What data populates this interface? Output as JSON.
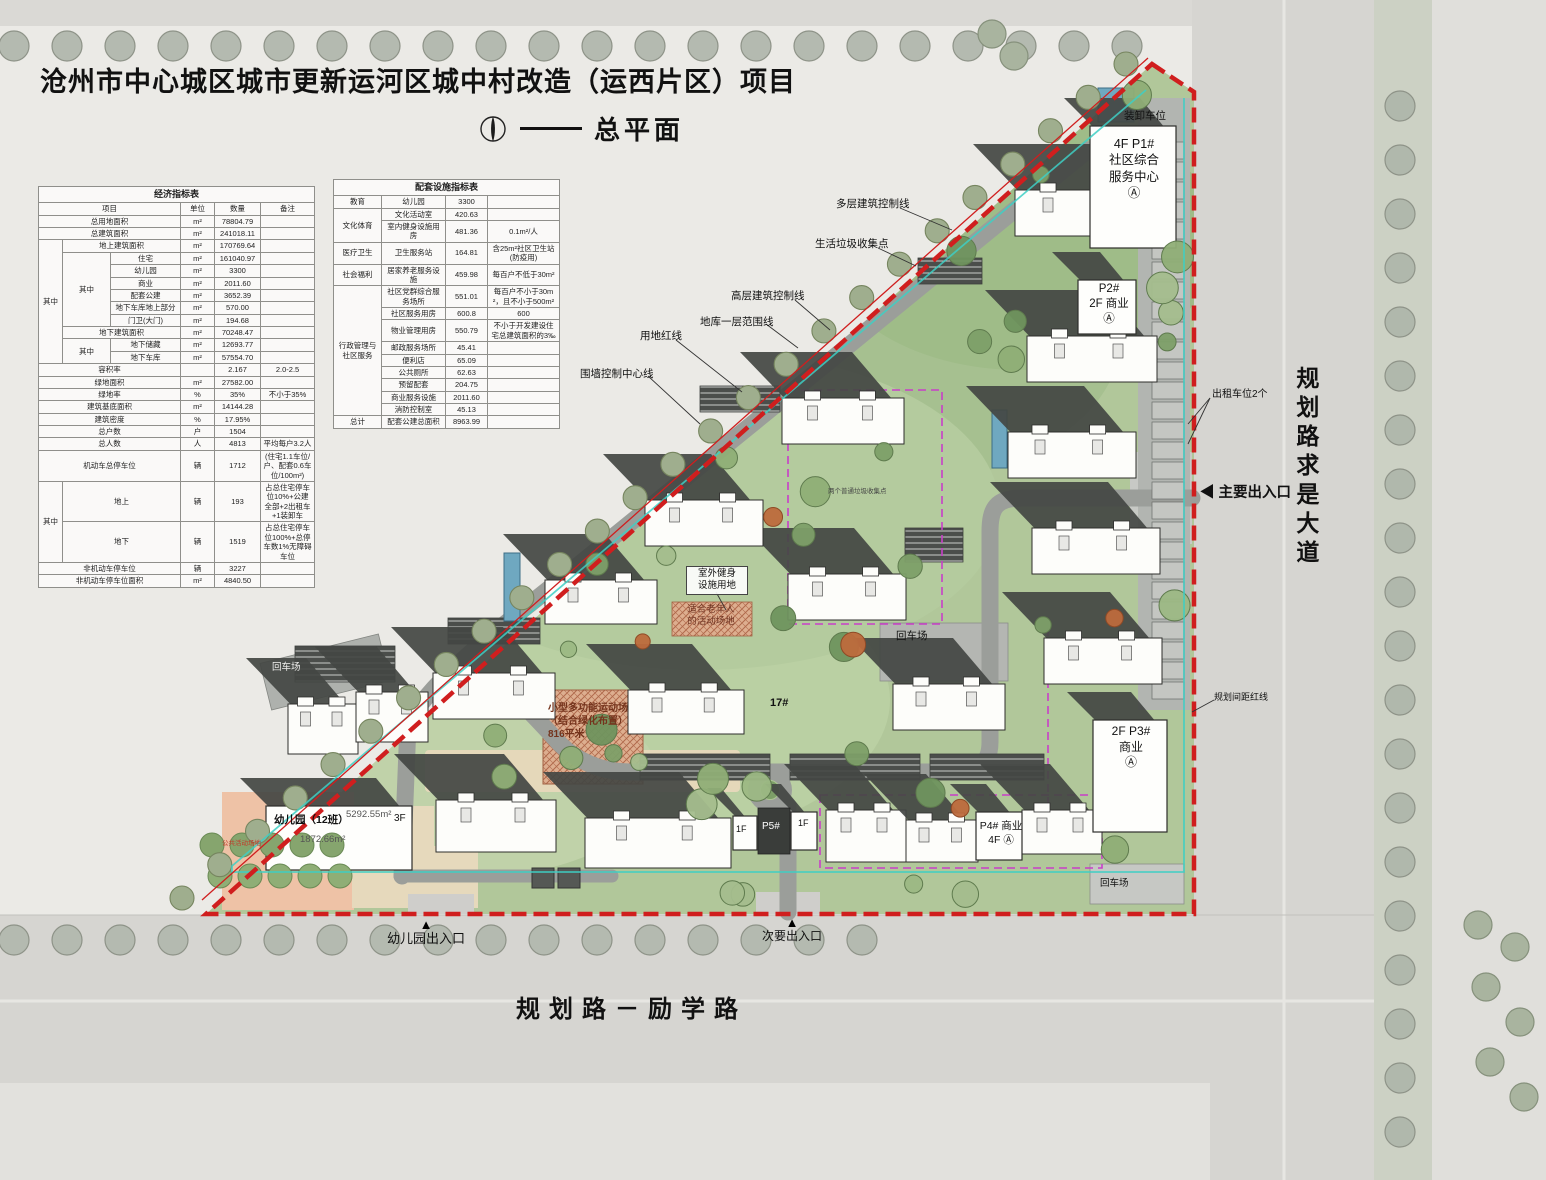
{
  "header": {
    "title": "沧州市中心城区城市更新运河区城中村改造（运西片区）项目",
    "subtitle": "总平面",
    "north_dash": "——"
  },
  "eco_table": {
    "rows": [
      [
        {
          "t": "经济指标表",
          "c": 6,
          "cls": "th"
        }
      ],
      [
        {
          "t": "项目",
          "c": 3
        },
        {
          "t": "单位"
        },
        {
          "t": "数量"
        },
        {
          "t": "备注"
        }
      ],
      [
        {
          "t": "总用地面积",
          "c": 3
        },
        {
          "t": "m²"
        },
        {
          "t": "78804.79"
        },
        {
          "t": ""
        }
      ],
      [
        {
          "t": "总建筑面积",
          "c": 3
        },
        {
          "t": "m²"
        },
        {
          "t": "241018.11"
        },
        {
          "t": ""
        }
      ],
      [
        {
          "t": "其中",
          "r": 10
        },
        {
          "t": "地上建筑面积",
          "c": 2
        },
        {
          "t": "m²"
        },
        {
          "t": "170769.64"
        },
        {
          "t": ""
        }
      ],
      [
        {
          "t": "其中",
          "r": 6
        },
        {
          "t": "住宅"
        },
        {
          "t": "m²"
        },
        {
          "t": "161040.97"
        },
        {
          "t": ""
        }
      ],
      [
        {
          "t": "幼儿园"
        },
        {
          "t": "m²"
        },
        {
          "t": "3300"
        },
        {
          "t": ""
        }
      ],
      [
        {
          "t": "商业"
        },
        {
          "t": "m²"
        },
        {
          "t": "2011.60"
        },
        {
          "t": ""
        }
      ],
      [
        {
          "t": "配套公建"
        },
        {
          "t": "m²"
        },
        {
          "t": "3652.39"
        },
        {
          "t": ""
        }
      ],
      [
        {
          "t": "地下车库地上部分"
        },
        {
          "t": "m²"
        },
        {
          "t": "570.00"
        },
        {
          "t": ""
        }
      ],
      [
        {
          "t": "门卫(大门)"
        },
        {
          "t": "m²"
        },
        {
          "t": "194.68"
        },
        {
          "t": ""
        }
      ],
      [
        {
          "t": "地下建筑面积",
          "c": 2
        },
        {
          "t": "m²"
        },
        {
          "t": "70248.47"
        },
        {
          "t": ""
        }
      ],
      [
        {
          "t": "其中",
          "r": 2
        },
        {
          "t": "地下储藏"
        },
        {
          "t": "m²"
        },
        {
          "t": "12693.77"
        },
        {
          "t": ""
        }
      ],
      [
        {
          "t": "地下车库"
        },
        {
          "t": "m²"
        },
        {
          "t": "57554.70"
        },
        {
          "t": ""
        }
      ],
      [
        {
          "t": "容积率",
          "c": 3
        },
        {
          "t": ""
        },
        {
          "t": "2.167"
        },
        {
          "t": "2.0-2.5"
        }
      ],
      [
        {
          "t": "绿地面积",
          "c": 3
        },
        {
          "t": "m²"
        },
        {
          "t": "27582.00"
        },
        {
          "t": ""
        }
      ],
      [
        {
          "t": "绿地率",
          "c": 3
        },
        {
          "t": "%"
        },
        {
          "t": "35%"
        },
        {
          "t": "不小于35%"
        }
      ],
      [
        {
          "t": "建筑基底面积",
          "c": 3
        },
        {
          "t": "m²"
        },
        {
          "t": "14144.28"
        },
        {
          "t": ""
        }
      ],
      [
        {
          "t": "建筑密度",
          "c": 3
        },
        {
          "t": "%"
        },
        {
          "t": "17.95%"
        },
        {
          "t": ""
        }
      ],
      [
        {
          "t": "总户数",
          "c": 3
        },
        {
          "t": "户"
        },
        {
          "t": "1504"
        },
        {
          "t": ""
        }
      ],
      [
        {
          "t": "总人数",
          "c": 3
        },
        {
          "t": "人"
        },
        {
          "t": "4813"
        },
        {
          "t": "平均每户3.2人"
        }
      ],
      [
        {
          "t": "机动车总停车位",
          "c": 3
        },
        {
          "t": "辆"
        },
        {
          "t": "1712"
        },
        {
          "t": "(住宅1.1车位/户、配套0.6车位/100m²)"
        }
      ],
      [
        {
          "t": "其中",
          "r": 2
        },
        {
          "t": "地上",
          "c": 2
        },
        {
          "t": "辆"
        },
        {
          "t": "193"
        },
        {
          "t": "占总住宅停车位10%+公建全部+2出租车+1装卸车"
        }
      ],
      [
        {
          "t": "地下",
          "c": 2
        },
        {
          "t": "辆"
        },
        {
          "t": "1519"
        },
        {
          "t": "占总住宅停车位100%+总停车数1%无障碍车位"
        }
      ],
      [
        {
          "t": "非机动车停车位",
          "c": 3
        },
        {
          "t": "辆"
        },
        {
          "t": "3227"
        },
        {
          "t": ""
        }
      ],
      [
        {
          "t": "非机动车停车位面积",
          "c": 3
        },
        {
          "t": "m²"
        },
        {
          "t": "4840.50"
        },
        {
          "t": ""
        }
      ]
    ]
  },
  "fac_table": {
    "rows": [
      [
        {
          "t": "配套设施指标表",
          "c": 4,
          "cls": "th"
        }
      ],
      [
        {
          "t": "教育"
        },
        {
          "t": "幼儿园"
        },
        {
          "t": "3300"
        },
        {
          "t": ""
        }
      ],
      [
        {
          "t": "文化体育",
          "r": 2
        },
        {
          "t": "文化活动室"
        },
        {
          "t": "420.63"
        },
        {
          "t": ""
        }
      ],
      [
        {
          "t": "室内健身设施用房"
        },
        {
          "t": "481.36"
        },
        {
          "t": "0.1m²/人"
        }
      ],
      [
        {
          "t": "医疗卫生"
        },
        {
          "t": "卫生服务站"
        },
        {
          "t": "164.81"
        },
        {
          "t": "含25m²社区卫生站(防疫用)"
        }
      ],
      [
        {
          "t": "社会福利"
        },
        {
          "t": "居家养老服务设施"
        },
        {
          "t": "459.98"
        },
        {
          "t": "每百户不低于30m²"
        }
      ],
      [
        {
          "t": "行政管理与社区服务",
          "r": 9
        },
        {
          "t": "社区党群综合服务场所"
        },
        {
          "t": "551.01"
        },
        {
          "t": "每百户不小于30m²，且不小于500m²"
        }
      ],
      [
        {
          "t": "社区服务用房"
        },
        {
          "t": "600.8"
        },
        {
          "t": "600"
        }
      ],
      [
        {
          "t": "物业管理用房"
        },
        {
          "t": "550.79"
        },
        {
          "t": "不小于开发建设住宅总建筑面积的3‰"
        }
      ],
      [
        {
          "t": "邮政服务场所"
        },
        {
          "t": "45.41"
        },
        {
          "t": ""
        }
      ],
      [
        {
          "t": "便利店"
        },
        {
          "t": "65.09"
        },
        {
          "t": ""
        }
      ],
      [
        {
          "t": "公共厕所"
        },
        {
          "t": "62.63"
        },
        {
          "t": ""
        }
      ],
      [
        {
          "t": "预留配套"
        },
        {
          "t": "204.75"
        },
        {
          "t": ""
        }
      ],
      [
        {
          "t": "商业服务设施"
        },
        {
          "t": "2011.60"
        },
        {
          "t": ""
        }
      ],
      [
        {
          "t": "消防控制室"
        },
        {
          "t": "45.13"
        },
        {
          "t": ""
        }
      ],
      [
        {
          "t": "总计"
        },
        {
          "t": "配套公建总面积"
        },
        {
          "t": "8963.99"
        },
        {
          "t": ""
        }
      ]
    ]
  },
  "labels": {
    "loading_bay": "装卸车位",
    "p1": "4F  P1#\n社区综合\n服务中心\nⒶ",
    "ctrl_multilayer": "多层建筑控制线",
    "ctrl_waste": "生活垃圾收集点",
    "ctrl_highrise": "高层建筑控制线",
    "ctrl_basement": "地库一层范围线",
    "ctrl_redline": "用地红线",
    "ctrl_wall": "围墙控制中心线",
    "p2": "P2#\n2F 商业\nⒶ",
    "taxi": "出租车位2个",
    "main_entrance": "主要出入口",
    "fitness": "室外健身\n设施用地",
    "elderly": "适合老年人\n的活动场地",
    "waste_point": "两个普通垃圾收集点",
    "turnaround_left": "回车场",
    "turnaround_mid": "回车场",
    "turnaround_br": "回车场",
    "b17": "17#",
    "sports": "小型多功能运动场\n（结合绿化布置）\n816平米",
    "spacing_redline": "规划间距红线",
    "p3": "2F  P3#\n商业\nⒶ",
    "p4": "P4# 商业\n4F Ⓐ",
    "p5": "P5#",
    "f1a": "1F",
    "f1b": "1F",
    "kg_name": "幼儿园（12班）",
    "kg_area1": "5292.55m²",
    "kg_floors": "3F",
    "kg_area2": "1872.66m²",
    "public_activity": "公共活动场地",
    "kg_entrance": "幼儿园出入口",
    "secondary_entrance": "次要出入口"
  },
  "roads": {
    "east": "规划路求是大道",
    "south": "规划路－励学路"
  },
  "icons": {
    "entrance_up": "▲",
    "entrance_left": "◀"
  }
}
